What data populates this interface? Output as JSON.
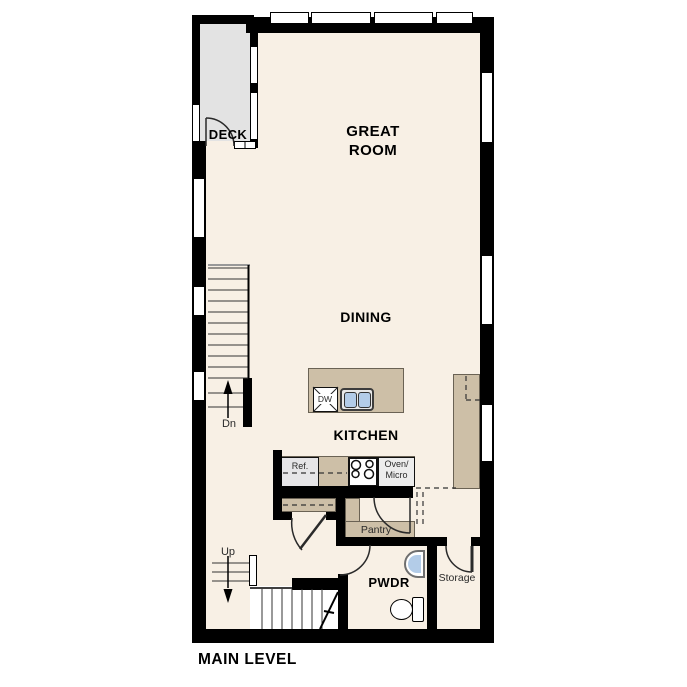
{
  "title": {
    "text": "MAIN LEVEL"
  },
  "rooms": {
    "deck": {
      "label": "DECK"
    },
    "great_room": {
      "label": "GREAT ROOM"
    },
    "dining": {
      "label": "DINING"
    },
    "kitchen": {
      "label": "KITCHEN"
    },
    "pwdr": {
      "label": "PWDR"
    },
    "pantry": {
      "label": "Pantry"
    },
    "storage": {
      "label": "Storage"
    }
  },
  "stairs": {
    "down_label": "Dn",
    "up_label": "Up"
  },
  "appliances": {
    "dishwasher": "DW",
    "refrigerator": "Ref.",
    "oven_micro_line1": "Oven/",
    "oven_micro_line2": "Micro"
  },
  "colors": {
    "wall": "#000000",
    "floor": "#f8f0e5",
    "deck_floor": "#e3e3e3",
    "counter_tan": "#cdbfa7",
    "sink_blue": "#b3cce8",
    "appliance_gray": "#e7e7e7",
    "window_white": "#ffffff"
  }
}
